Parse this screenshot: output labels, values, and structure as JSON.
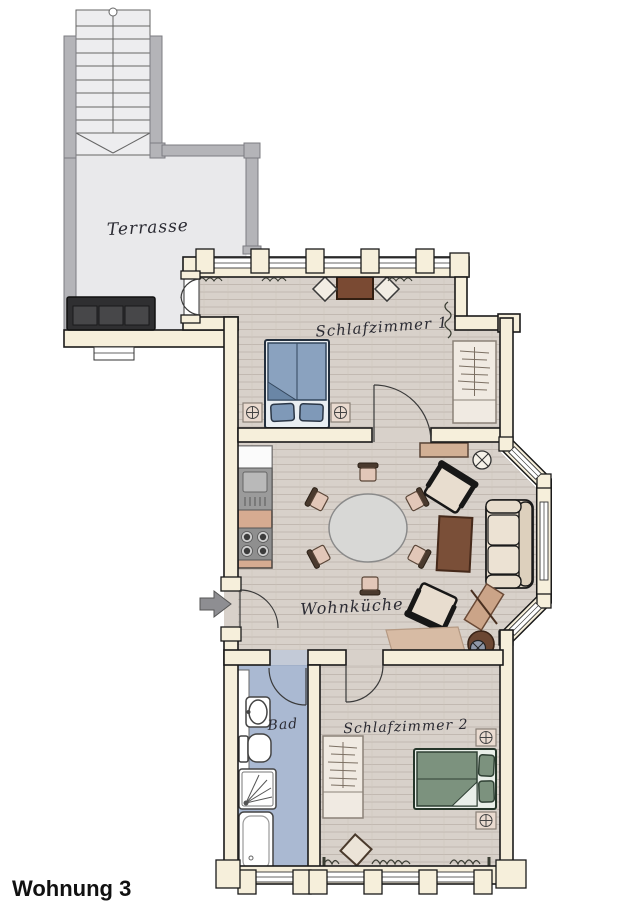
{
  "title": "Wohnung 3",
  "rooms": {
    "terrace": {
      "label": "Terrasse"
    },
    "bedroom1": {
      "label": "Schlafzimmer 1"
    },
    "living_kitchen": {
      "label": "Wohnküche"
    },
    "bath": {
      "label": "Bad"
    },
    "bedroom2": {
      "label": "Schlafzimmer 2"
    }
  },
  "colors": {
    "exterior_wall": "#b4b4b8",
    "apartment_wall": "#f6efdb",
    "wood_floor": "#d8d1ca",
    "terrace_floor": "#e9e9eb",
    "bath_floor": "#aab9d2",
    "bed_blue": "#8aa2bf",
    "bed_green": "#7c927e",
    "furniture_tan": "#d2b095",
    "table_brown": "#7a4f38",
    "upholstery_cream": "#e7dccc",
    "terrace_sofa": "#2f2f31",
    "entry_arrow": "#8e8e92",
    "ink": "#2b2b33"
  }
}
